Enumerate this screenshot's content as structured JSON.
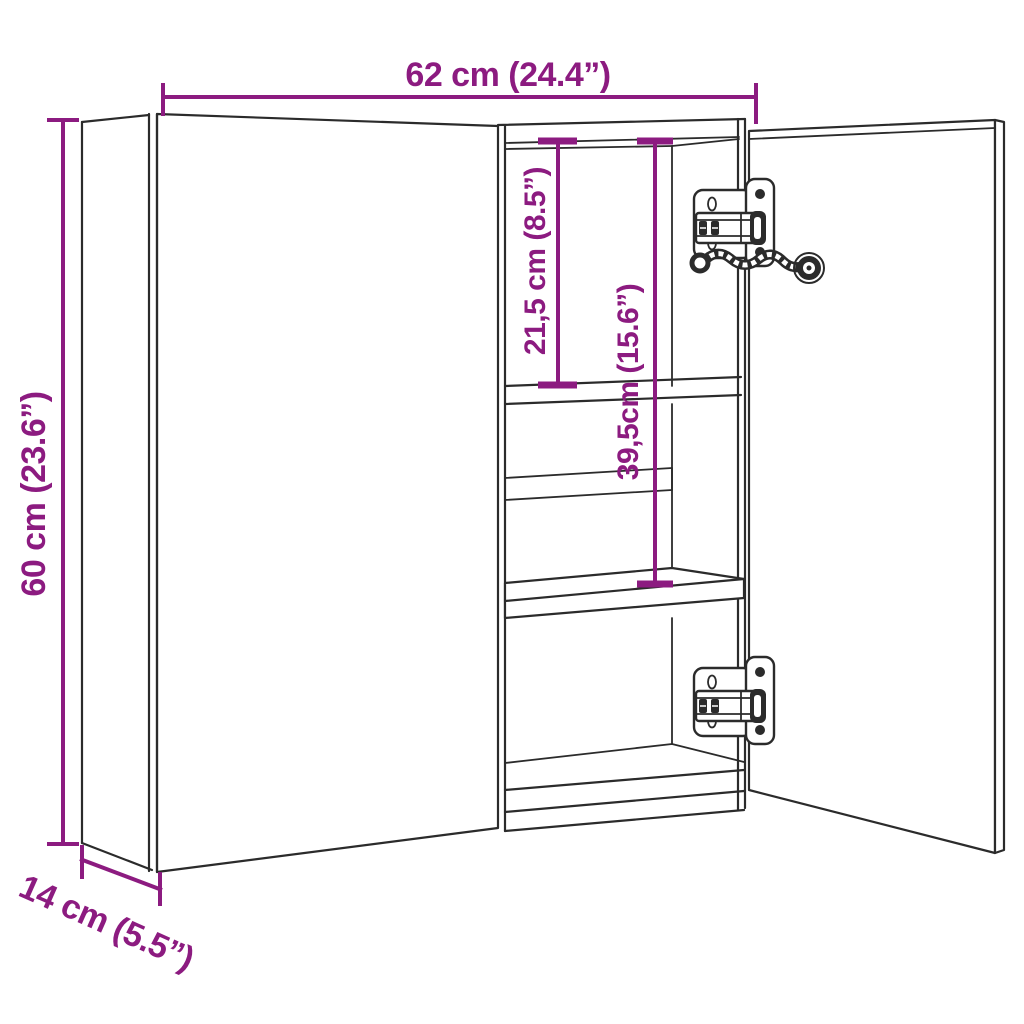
{
  "diagram": {
    "type": "product-dimension-line-drawing",
    "dimensions": {
      "width": "62 cm (24.4”)",
      "height": "60 cm (23.6”)",
      "depth": "14 cm (5.5”)",
      "top_shelf_spacing": "21,5 cm (8.5”)",
      "middle_shelf_spacing": "39,5cm (15.6”)"
    },
    "colors": {
      "dimension_lines": "#8c1b80",
      "drawing_lines": "#2b2b2b",
      "background": "#ffffff"
    },
    "icons": {
      "hinge_top": "cabinet-hinge-icon",
      "hinge_bottom": "cabinet-hinge-icon",
      "cable": "flexible-cable-icon"
    }
  }
}
